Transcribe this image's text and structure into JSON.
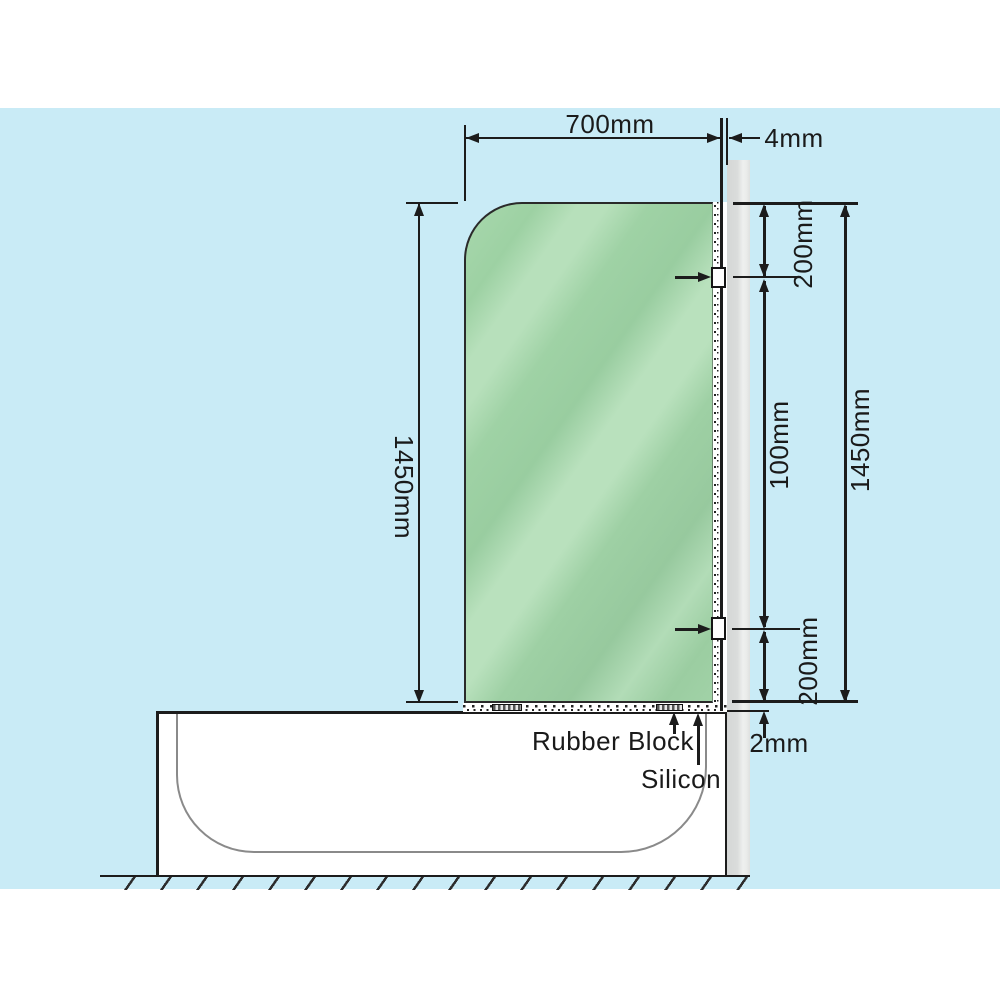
{
  "diagram": {
    "type": "shower-screen-installation-drawing",
    "colors": {
      "background_blue": "#c9ebf6",
      "glass_green": "#9ccfa2",
      "glass_highlight": "#b9e1bd",
      "wall_gray": "#dadcdb",
      "line_black": "#1c1c1c",
      "tub_inner_gray": "#8a8a8a"
    },
    "dimensions": {
      "glass_width": "700mm",
      "wall_gap": "4mm",
      "glass_height_left": "1450mm",
      "top_bracket_offset": "200mm",
      "bracket_span": "100mm",
      "glass_height_right": "1450mm",
      "bottom_bracket_offset": "200mm",
      "base_gap": "2mm"
    },
    "annotations": {
      "rubber_block": "Rubber Block",
      "silicon": "Silicon"
    }
  }
}
